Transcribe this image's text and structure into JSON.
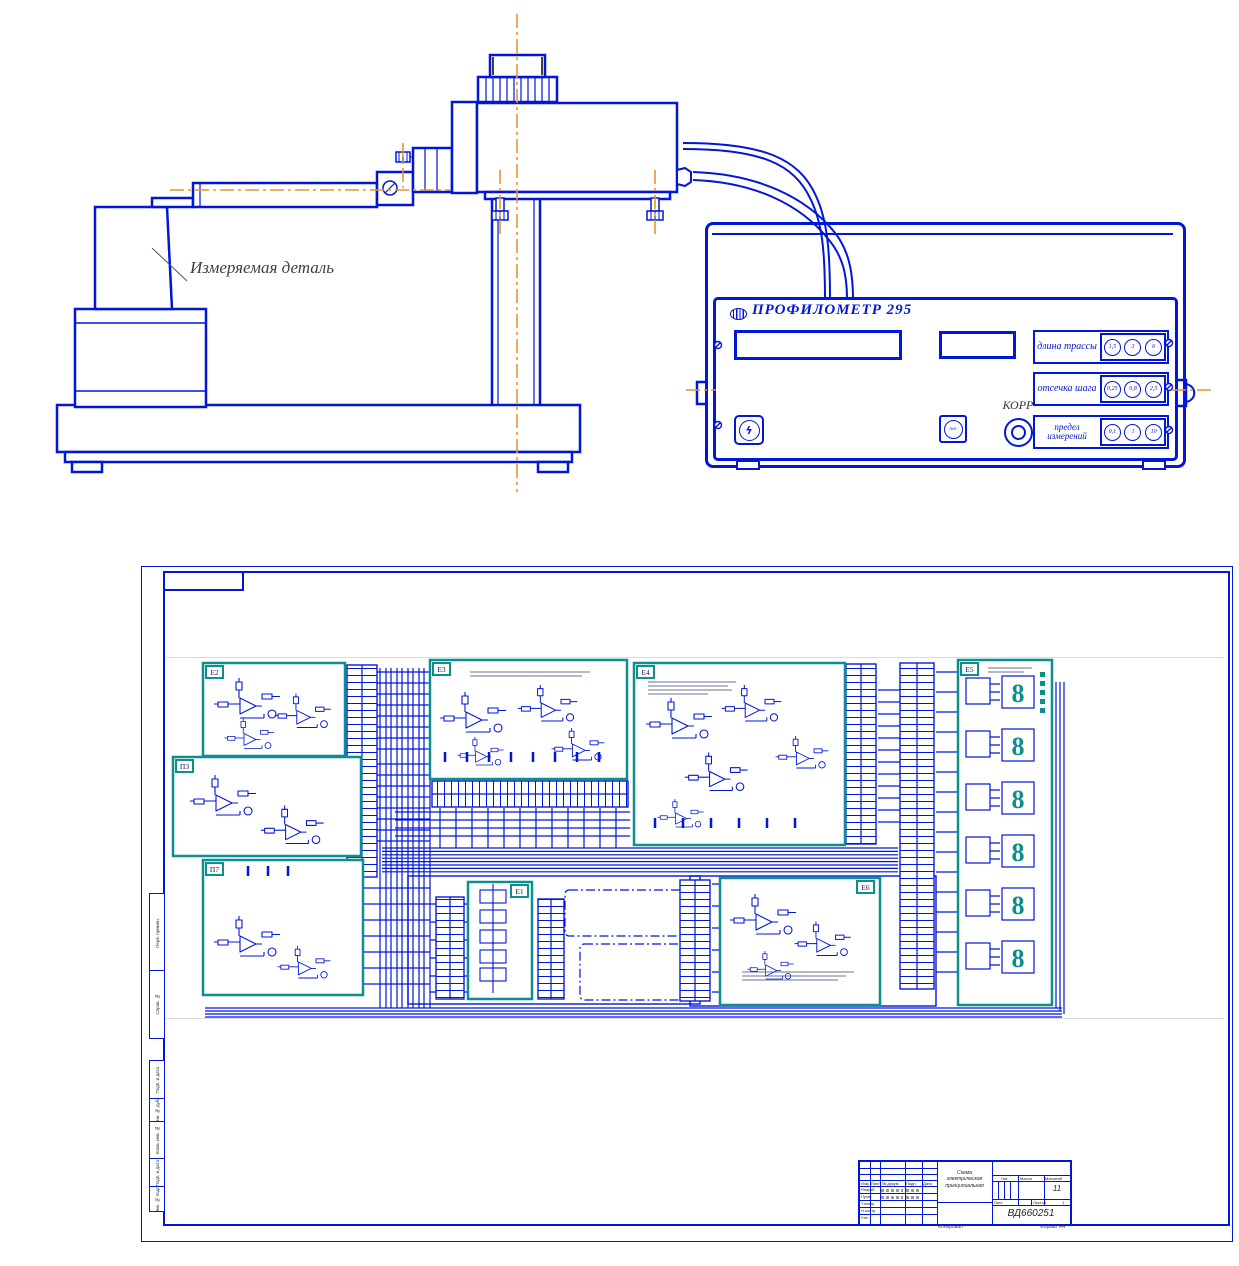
{
  "drawing": {
    "part_label": "Измеряемая деталь"
  },
  "panel": {
    "logo_icon": "manufacturer-logo",
    "title": "ПРОФИЛОМЕТР 295",
    "power_icon": "lightning",
    "start_button_label": "пск",
    "knob_label": "КОРР",
    "groups": [
      {
        "label": "длина трассы",
        "label2": "",
        "buttons": [
          "1,5",
          "3",
          "6"
        ]
      },
      {
        "label": "отсечка шага",
        "label2": "",
        "buttons": [
          "0,25",
          "0,8",
          "2,5"
        ]
      },
      {
        "label": "предел",
        "label2": "измерений",
        "buttons": [
          "0,1",
          "1",
          "10"
        ]
      }
    ]
  },
  "sheet": {
    "display_digit": "8",
    "blocks": [
      {
        "id": "Е2"
      },
      {
        "id": "П3"
      },
      {
        "id": "П7"
      },
      {
        "id": "Е3"
      },
      {
        "id": "Е4"
      },
      {
        "id": "Е5"
      },
      {
        "id": "Е1"
      },
      {
        "id": "Е6"
      }
    ],
    "margin_labels": [
      "Перв. примен.",
      "Справ. №",
      "Подп. и дата",
      "Инв. № дубл.",
      "Взам. инв. №",
      "Подп. и дата",
      "Инв. № подл."
    ],
    "title_block": {
      "change_header": [
        "Изм.",
        "Лист",
        "№ докум.",
        "Подп.",
        "Дата"
      ],
      "rows": [
        "Разраб.",
        "Пров.",
        "Т.контр.",
        "Н.контр.",
        "Утв."
      ],
      "doc_title_lines": [
        "Схема",
        "электрическая",
        "принципиальная"
      ],
      "lit": "Лит.",
      "mass": "Масса",
      "scale": "Масштаб",
      "scale_value": "11",
      "sheet": "Лист",
      "sheets": "Листов",
      "sheets_value": "1",
      "doc_number": "ВД660251",
      "copied": "Копировал",
      "format": "Формат А4"
    }
  }
}
